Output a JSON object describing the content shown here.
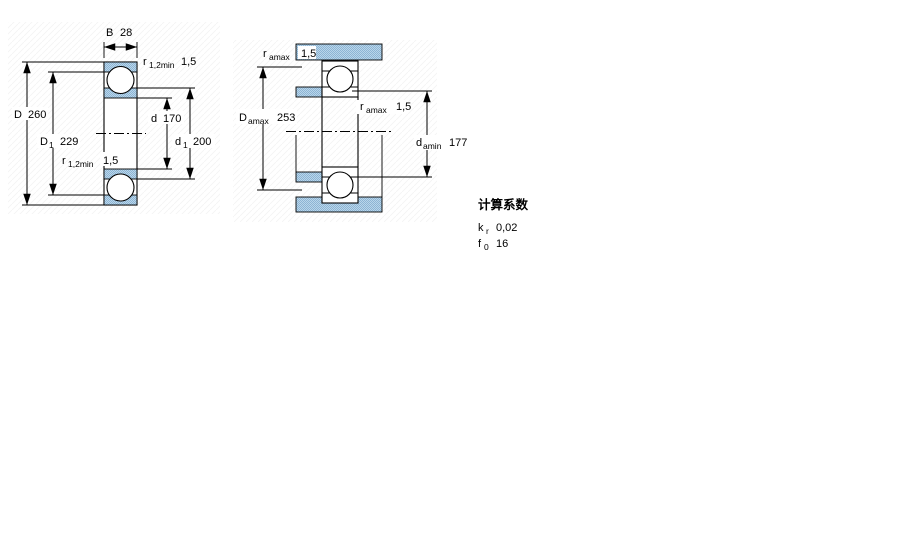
{
  "figures": {
    "left": {
      "dims": {
        "B": {
          "symbol": "B",
          "sub": "",
          "value": "28"
        },
        "r_top": {
          "symbol": "r",
          "sub": "1,2min",
          "value": "1,5"
        },
        "D": {
          "symbol": "D",
          "sub": "",
          "value": "260"
        },
        "D1": {
          "symbol": "D",
          "sub": "1",
          "value": "229"
        },
        "r_bottom": {
          "symbol": "r",
          "sub": "1,2min",
          "value": "1,5"
        },
        "d": {
          "symbol": "d",
          "sub": "",
          "value": "170"
        },
        "d1": {
          "symbol": "d",
          "sub": "1",
          "value": "200"
        }
      }
    },
    "right": {
      "dims": {
        "ra_top": {
          "symbol": "r",
          "sub": "amax",
          "value": "1,5"
        },
        "Da": {
          "symbol": "D",
          "sub": "amax",
          "value": "253"
        },
        "ra_mid": {
          "symbol": "r",
          "sub": "amax",
          "value": "1,5"
        },
        "da": {
          "symbol": "d",
          "sub": "amin",
          "value": "177"
        }
      }
    }
  },
  "factors": {
    "title": "计算系数",
    "rows": [
      {
        "symbol": "k",
        "sub": "r",
        "value": "0,02"
      },
      {
        "symbol": "f",
        "sub": "0",
        "value": "16"
      }
    ]
  },
  "colors": {
    "line": "#000000",
    "steel_light": "#b9d6ea",
    "steel_dark": "#8db4d4"
  }
}
